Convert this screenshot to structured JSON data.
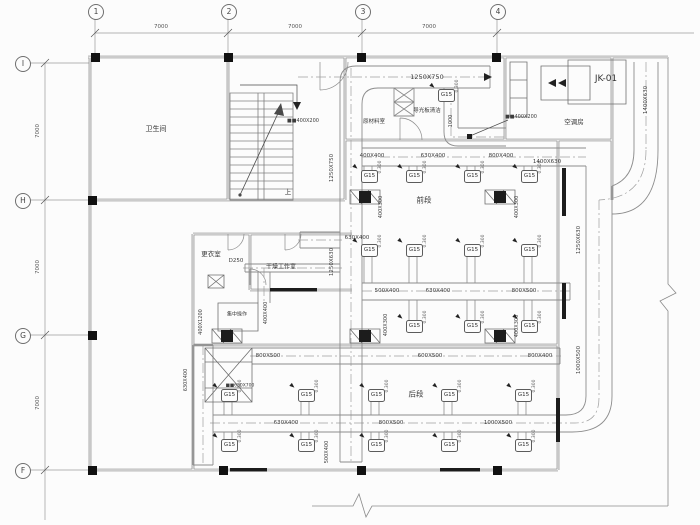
{
  "colors": {
    "background": "#fcfcfc",
    "duct_line": "#8c8c8c",
    "wall_line": "#777777",
    "dark_fill": "#1c1c1c",
    "text": "#3d3d3d"
  },
  "grid": {
    "top_bubbles": [
      {
        "label": "1",
        "x": 95,
        "y": 11
      },
      {
        "label": "2",
        "x": 228,
        "y": 11
      },
      {
        "label": "3",
        "x": 362,
        "y": 11
      },
      {
        "label": "4",
        "x": 497,
        "y": 11
      }
    ],
    "left_bubbles": [
      {
        "label": "I",
        "x": 22,
        "y": 63
      },
      {
        "label": "H",
        "x": 22,
        "y": 200
      },
      {
        "label": "G",
        "x": 22,
        "y": 335
      },
      {
        "label": "F",
        "x": 22,
        "y": 470
      }
    ],
    "dim_labels": [
      {
        "text": "7000",
        "x": 161,
        "y": 27
      },
      {
        "text": "7000",
        "x": 295,
        "y": 27
      },
      {
        "text": "7000",
        "x": 429,
        "y": 27
      },
      {
        "text": "7000",
        "x": 38,
        "y": 131,
        "r": 1
      },
      {
        "text": "7000",
        "x": 38,
        "y": 267,
        "r": 1
      },
      {
        "text": "7000",
        "x": 38,
        "y": 403,
        "r": 1
      }
    ]
  },
  "rooms": [
    {
      "name": "卫生间",
      "x": 156,
      "y": 129,
      "s": 7
    },
    {
      "name": "原材料室",
      "x": 374,
      "y": 121,
      "s": 5.5
    },
    {
      "name": "导光板清洁",
      "x": 427,
      "y": 110,
      "s": 5.5
    },
    {
      "name": "空调房",
      "x": 574,
      "y": 121,
      "s": 6.5
    },
    {
      "name": "JK-01",
      "x": 606,
      "y": 79,
      "s": 9
    },
    {
      "name": "前段",
      "x": 424,
      "y": 200,
      "s": 7.5
    },
    {
      "name": "更衣室",
      "x": 211,
      "y": 253,
      "s": 6.5
    },
    {
      "name": "干燥工作室",
      "x": 281,
      "y": 266,
      "s": 6
    },
    {
      "name": "后段",
      "x": 416,
      "y": 394,
      "s": 7.5
    },
    {
      "name": "集中操作",
      "x": 237,
      "y": 314,
      "s": 5
    },
    {
      "name": "上",
      "x": 288,
      "y": 191,
      "s": 6.5
    }
  ],
  "duct_labels": [
    {
      "t": "1250X750",
      "x": 427,
      "y": 77,
      "s": 6.5
    },
    {
      "t": "■■400X200",
      "x": 303,
      "y": 121,
      "s": 5
    },
    {
      "t": "■■400X200",
      "x": 521,
      "y": 117,
      "s": 5
    },
    {
      "t": "400X400",
      "x": 372,
      "y": 156,
      "s": 5.5
    },
    {
      "t": "630X400",
      "x": 433,
      "y": 156,
      "s": 5.5
    },
    {
      "t": "800X400",
      "x": 501,
      "y": 156,
      "s": 5.5
    },
    {
      "t": "1400X630",
      "x": 547,
      "y": 162,
      "s": 5.5
    },
    {
      "t": "630X400",
      "x": 357,
      "y": 238,
      "s": 5.5
    },
    {
      "t": "D250",
      "x": 236,
      "y": 261,
      "s": 5.5
    },
    {
      "t": "500X400",
      "x": 387,
      "y": 291,
      "s": 5.5
    },
    {
      "t": "630X400",
      "x": 438,
      "y": 291,
      "s": 5.5
    },
    {
      "t": "800X500",
      "x": 524,
      "y": 291,
      "s": 5.5
    },
    {
      "t": "800X500",
      "x": 268,
      "y": 356,
      "s": 5.5
    },
    {
      "t": "600X500",
      "x": 430,
      "y": 356,
      "s": 5.5
    },
    {
      "t": "800X400",
      "x": 540,
      "y": 356,
      "s": 5.5
    },
    {
      "t": "■■630X700",
      "x": 240,
      "y": 386,
      "s": 4.5
    },
    {
      "t": "630X400",
      "x": 286,
      "y": 423,
      "s": 5.5
    },
    {
      "t": "800X500",
      "x": 391,
      "y": 423,
      "s": 5.5
    },
    {
      "t": "1000X500",
      "x": 498,
      "y": 423,
      "s": 5.5
    },
    {
      "t": "1250X750",
      "x": 332,
      "y": 168,
      "r": 1,
      "s": 5.5
    },
    {
      "t": "1250X630",
      "x": 332,
      "y": 262,
      "r": 1,
      "s": 5.5
    },
    {
      "t": "1250X630",
      "x": 579,
      "y": 240,
      "r": 1,
      "s": 5.5
    },
    {
      "t": "1400X630",
      "x": 646,
      "y": 100,
      "r": 1,
      "s": 5.5
    },
    {
      "t": "1000X500",
      "x": 579,
      "y": 360,
      "r": 1,
      "s": 5.5
    },
    {
      "t": "400X300",
      "x": 381,
      "y": 207,
      "r": 1,
      "s": 5
    },
    {
      "t": "400X300",
      "x": 517,
      "y": 207,
      "r": 1,
      "s": 5
    },
    {
      "t": "400X300",
      "x": 386,
      "y": 325,
      "r": 1,
      "s": 5
    },
    {
      "t": "400X300",
      "x": 517,
      "y": 326,
      "r": 1,
      "s": 5
    },
    {
      "t": "400X400",
      "x": 266,
      "y": 313,
      "r": 1,
      "s": 5
    },
    {
      "t": "400X1200",
      "x": 201,
      "y": 322,
      "r": 1,
      "s": 5
    },
    {
      "t": "630X400",
      "x": 186,
      "y": 380,
      "r": 1,
      "s": 5
    },
    {
      "t": "500X400",
      "x": 327,
      "y": 452,
      "r": 1,
      "s": 5
    },
    {
      "t": "1000",
      "x": 451,
      "y": 121,
      "r": 1,
      "s": 5
    }
  ],
  "diffusers": {
    "tag": "G15",
    "elevation_note": "0.300",
    "positions": [
      [
        368,
        176
      ],
      [
        413,
        176
      ],
      [
        471,
        176
      ],
      [
        528,
        176
      ],
      [
        368,
        250
      ],
      [
        413,
        250
      ],
      [
        471,
        250
      ],
      [
        528,
        250
      ],
      [
        413,
        326
      ],
      [
        471,
        326
      ],
      [
        528,
        326
      ],
      [
        228,
        395
      ],
      [
        305,
        395
      ],
      [
        375,
        395
      ],
      [
        448,
        395
      ],
      [
        522,
        395
      ],
      [
        228,
        445
      ],
      [
        305,
        445
      ],
      [
        375,
        445
      ],
      [
        448,
        445
      ],
      [
        522,
        445
      ],
      [
        445,
        95
      ]
    ]
  }
}
